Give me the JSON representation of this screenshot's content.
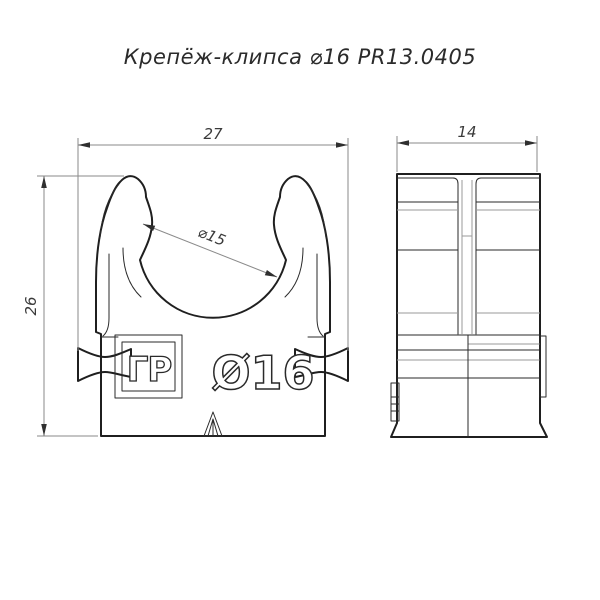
{
  "title": "Крепёж-клипса ⌀16 PR13.0405",
  "front_view": {
    "dim_width": "27",
    "dim_height": "26",
    "dim_inner_diameter": "⌀15",
    "stamp_diameter": "Ø16",
    "logo_text": "ГР"
  },
  "side_view": {
    "dim_depth": "14"
  },
  "colors": {
    "background": "#ffffff",
    "outline": "#1f1f1f",
    "thin_line": "#2a2a2a",
    "dim_line": "#8a8a8a",
    "label": "#3a3a3a"
  }
}
